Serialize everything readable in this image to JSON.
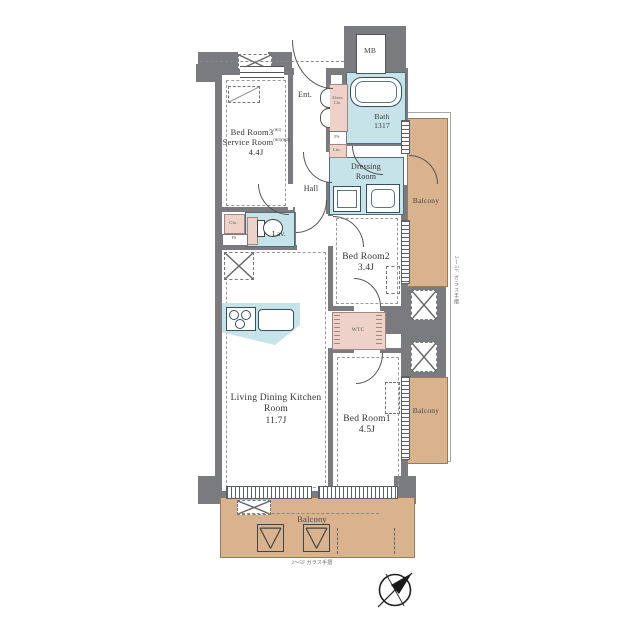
{
  "plan": {
    "labels": {
      "mb": "MB",
      "ent": "Ent.",
      "hall": "Hall",
      "bedroom3_line1": "Bed Room3",
      "bedroom3_note": "(※1)",
      "bedroom3_line2": "Service Room",
      "bedroom3_line2_note": "(※1)(※2)",
      "bedroom3_size": "4.4J",
      "shoes_line1": "Shoes",
      "shoes_line2": "Clo.",
      "bath": "Bath",
      "bath_size": "1317",
      "ps": "PS",
      "linen": "Lin.",
      "closet": "Clo.",
      "dressing_line1": "Dressing",
      "dressing_line2": "Room",
      "lavatory": "Lav.",
      "bedroom2": "Bed Room2",
      "bedroom2_size": "3.4J",
      "wtc": "WTC",
      "ldk_line1": "Living Dining Kitchen",
      "ldk_line2": "Room",
      "ldk_size": "11.7J",
      "bedroom1": "Bed Room1",
      "bedroom1_size": "4.5J",
      "balcony": "Balcony",
      "note_bottom": "2〜5F ガラス手摺",
      "note_right": "2〜5F ガラス手摺"
    },
    "colors": {
      "wall": "#797b7e",
      "wet_area": "#c7e3ea",
      "closet_pink": "#eed2ca",
      "balcony_tan": "#d9b28e",
      "line": "#555555"
    },
    "compass": "north-east"
  }
}
